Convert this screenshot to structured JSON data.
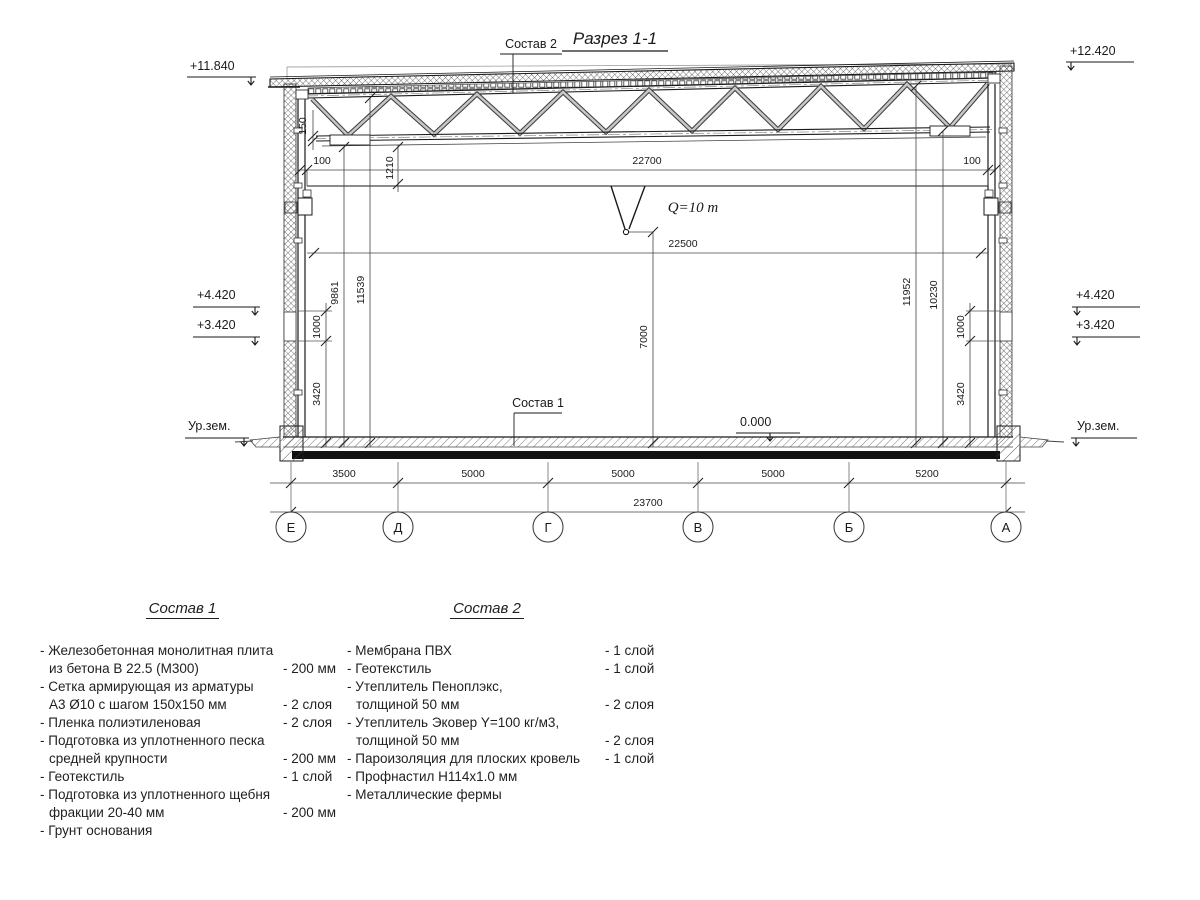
{
  "drawing": {
    "title": "Разрез 1-1",
    "sostav2_ref": "Состав 2",
    "sostav1_ref": "Состав 1",
    "crane_capacity": "Q=10 m",
    "elev": {
      "top_left": "+11.840",
      "top_right": "+12.420",
      "left_up": "+4.420",
      "left_low": "+3.420",
      "right_up": "+4.420",
      "right_low": "+3.420",
      "ground_left": "Ур.зем.",
      "ground_right": "Ур.зем.",
      "floor": "0.000"
    },
    "dims": {
      "chord": "150",
      "gap_left": "100",
      "gap_right": "100",
      "rail_span": "22700",
      "beam": "1210",
      "crane_span": "22500",
      "hook": "7000",
      "h_left_inner": "9861",
      "h_left_outer": "11539",
      "h_right_outer": "11952",
      "h_right_inner": "10230",
      "band_left": "1000",
      "base_left": "3420",
      "band_right": "1000",
      "base_right": "3420"
    },
    "axes": {
      "letters": [
        "Е",
        "Д",
        "Г",
        "В",
        "Б",
        "А"
      ],
      "spans": [
        "3500",
        "5000",
        "5000",
        "5000",
        "5200"
      ],
      "total": "23700"
    }
  },
  "sostav1": {
    "title": "Состав 1",
    "items": [
      {
        "l1": "- Железобетонная  монолитная плита",
        "l2": "из бетона В 22.5 (М300)",
        "v": "- 200 мм"
      },
      {
        "l1": "- Сетка армирующая из арматуры",
        "l2": "А3 Ø10 с шагом 150х150 мм",
        "v": "- 2 слоя"
      },
      {
        "l1": "- Пленка полиэтиленовая",
        "v": "- 2 слоя"
      },
      {
        "l1": "- Подготовка из уплотненного песка",
        "l2": "средней крупности",
        "v": "- 200 мм"
      },
      {
        "l1": "- Геотекстиль",
        "v": "- 1 слой"
      },
      {
        "l1": "- Подготовка из уплотненного щебня",
        "l2": "фракции 20-40 мм",
        "v": "- 200 мм"
      },
      {
        "l1": "- Грунт основания",
        "v": ""
      }
    ]
  },
  "sostav2": {
    "title": "Состав 2",
    "items": [
      {
        "l1": "- Мембрана ПВХ",
        "v": "- 1 слой"
      },
      {
        "l1": "- Геотекстиль",
        "v": "- 1 слой"
      },
      {
        "l1": "- Утеплитель Пеноплэкс,",
        "l2": "толщиной 50 мм",
        "v": "- 2 слоя"
      },
      {
        "l1": "- Утеплитель Эковер Y=100 кг/м3,",
        "l2": "толщиной 50 мм",
        "v": "- 2 слоя"
      },
      {
        "l1": "- Пароизоляция для плоских кровель",
        "v": "- 1 слой"
      },
      {
        "l1": "- Профнастил Н114х1.0 мм",
        "v": ""
      },
      {
        "l1": "- Металлические фермы",
        "v": ""
      }
    ]
  }
}
